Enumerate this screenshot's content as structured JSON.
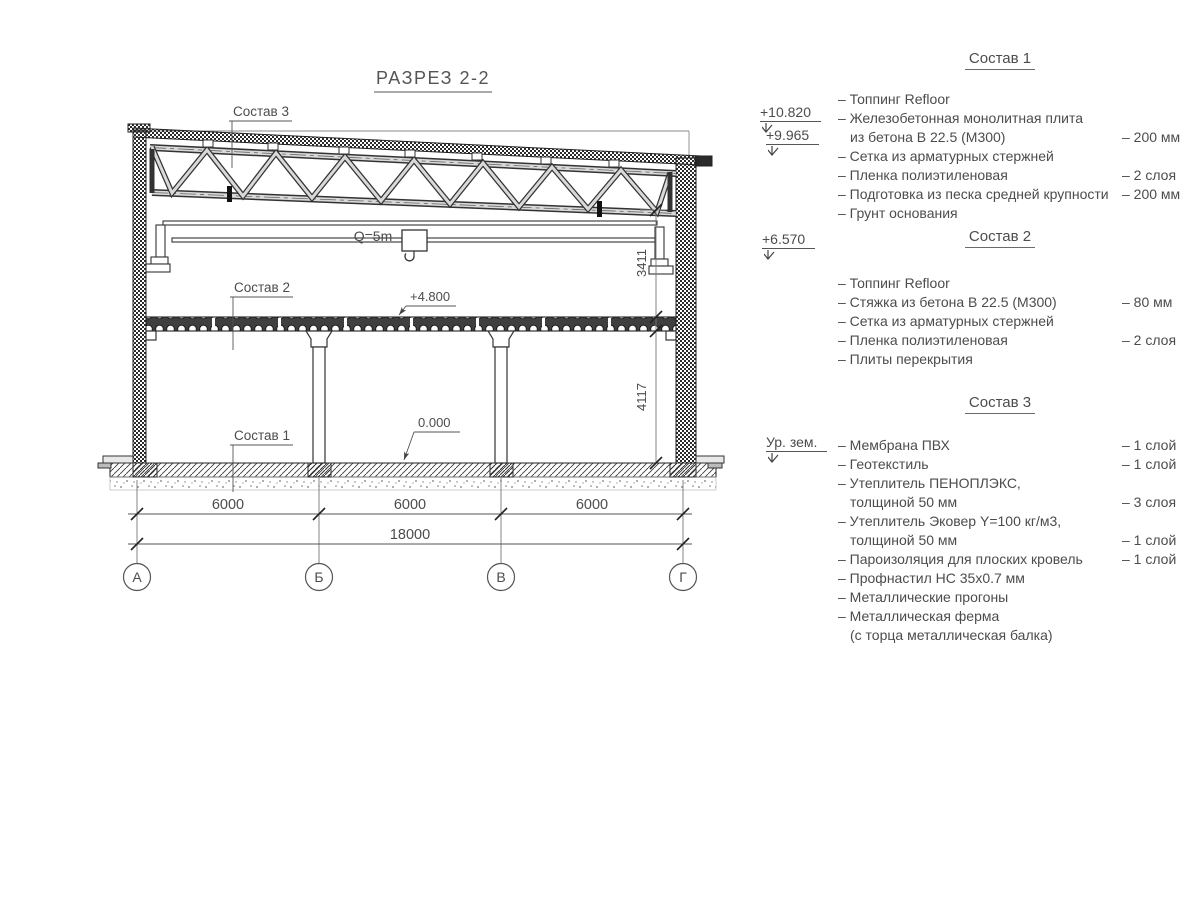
{
  "title": "РАЗРЕЗ 2-2",
  "drawing": {
    "callouts": {
      "sostav3": "Состав 3",
      "sostav2": "Состав 2",
      "sostav1": "Состав 1"
    },
    "crane": {
      "label": "Q=5m"
    },
    "levels": {
      "floor2": "+4.800",
      "floor1": "0.000"
    },
    "dims": {
      "v1": "3411",
      "v2": "4117",
      "b1": "6000",
      "b2": "6000",
      "b3": "6000",
      "total": "18000"
    },
    "axes": {
      "a": "А",
      "b": "Б",
      "v": "В",
      "g": "Г"
    }
  },
  "panel": {
    "marks": [
      {
        "label": "+10.820"
      },
      {
        "label": "+9.965"
      },
      {
        "label": "+6.570"
      },
      {
        "label": "Ур. зем."
      }
    ],
    "comp1": {
      "heading": "Состав 1",
      "rows": [
        {
          "text": "– Топпинг Refloor",
          "value": ""
        },
        {
          "text": "– Железобетонная  монолитная плита",
          "value": ""
        },
        {
          "text": "из бетона В 22.5 (М300)",
          "value": "– 200 мм"
        },
        {
          "text": "– Сетка из арматурных стержней",
          "value": ""
        },
        {
          "text": "– Пленка полиэтиленовая",
          "value": "– 2 слоя"
        },
        {
          "text": "– Подготовка из песка средней крупности",
          "value": "– 200 мм"
        },
        {
          "text": "– Грунт основания",
          "value": ""
        }
      ]
    },
    "comp2": {
      "heading": "Состав 2",
      "rows": [
        {
          "text": "– Топпинг Refloor",
          "value": ""
        },
        {
          "text": "– Стяжка из бетона В 22.5 (М300)",
          "value": "– 80 мм"
        },
        {
          "text": "– Сетка из арматурных стержней",
          "value": ""
        },
        {
          "text": "– Пленка полиэтиленовая",
          "value": "– 2 слоя"
        },
        {
          "text": "– Плиты перекрытия",
          "value": ""
        }
      ]
    },
    "comp3": {
      "heading": "Состав 3",
      "rows": [
        {
          "text": "– Мембрана ПВХ",
          "value": "– 1 слой"
        },
        {
          "text": "– Геотекстиль",
          "value": "– 1 слой"
        },
        {
          "text": "– Утеплитель ПЕНОПЛЭКС,",
          "value": ""
        },
        {
          "text": "толщиной 50 мм",
          "value": "– 3 слоя"
        },
        {
          "text": "– Утеплитель Эковер Y=100 кг/м3,",
          "value": ""
        },
        {
          "text": "толщиной 50 мм",
          "value": "– 1 слой"
        },
        {
          "text": "– Пароизоляция для плоских кровель",
          "value": "– 1 слой"
        },
        {
          "text": "– Профнастил НС 35х0.7 мм",
          "value": ""
        },
        {
          "text": "– Металлические прогоны",
          "value": ""
        },
        {
          "text": "– Металлическая ферма",
          "value": ""
        },
        {
          "text": "(с торца металлическая балка)",
          "value": ""
        }
      ]
    }
  },
  "colors": {
    "line": "#2a2a2a",
    "text": "#4c4c4c",
    "background": "#ffffff"
  }
}
